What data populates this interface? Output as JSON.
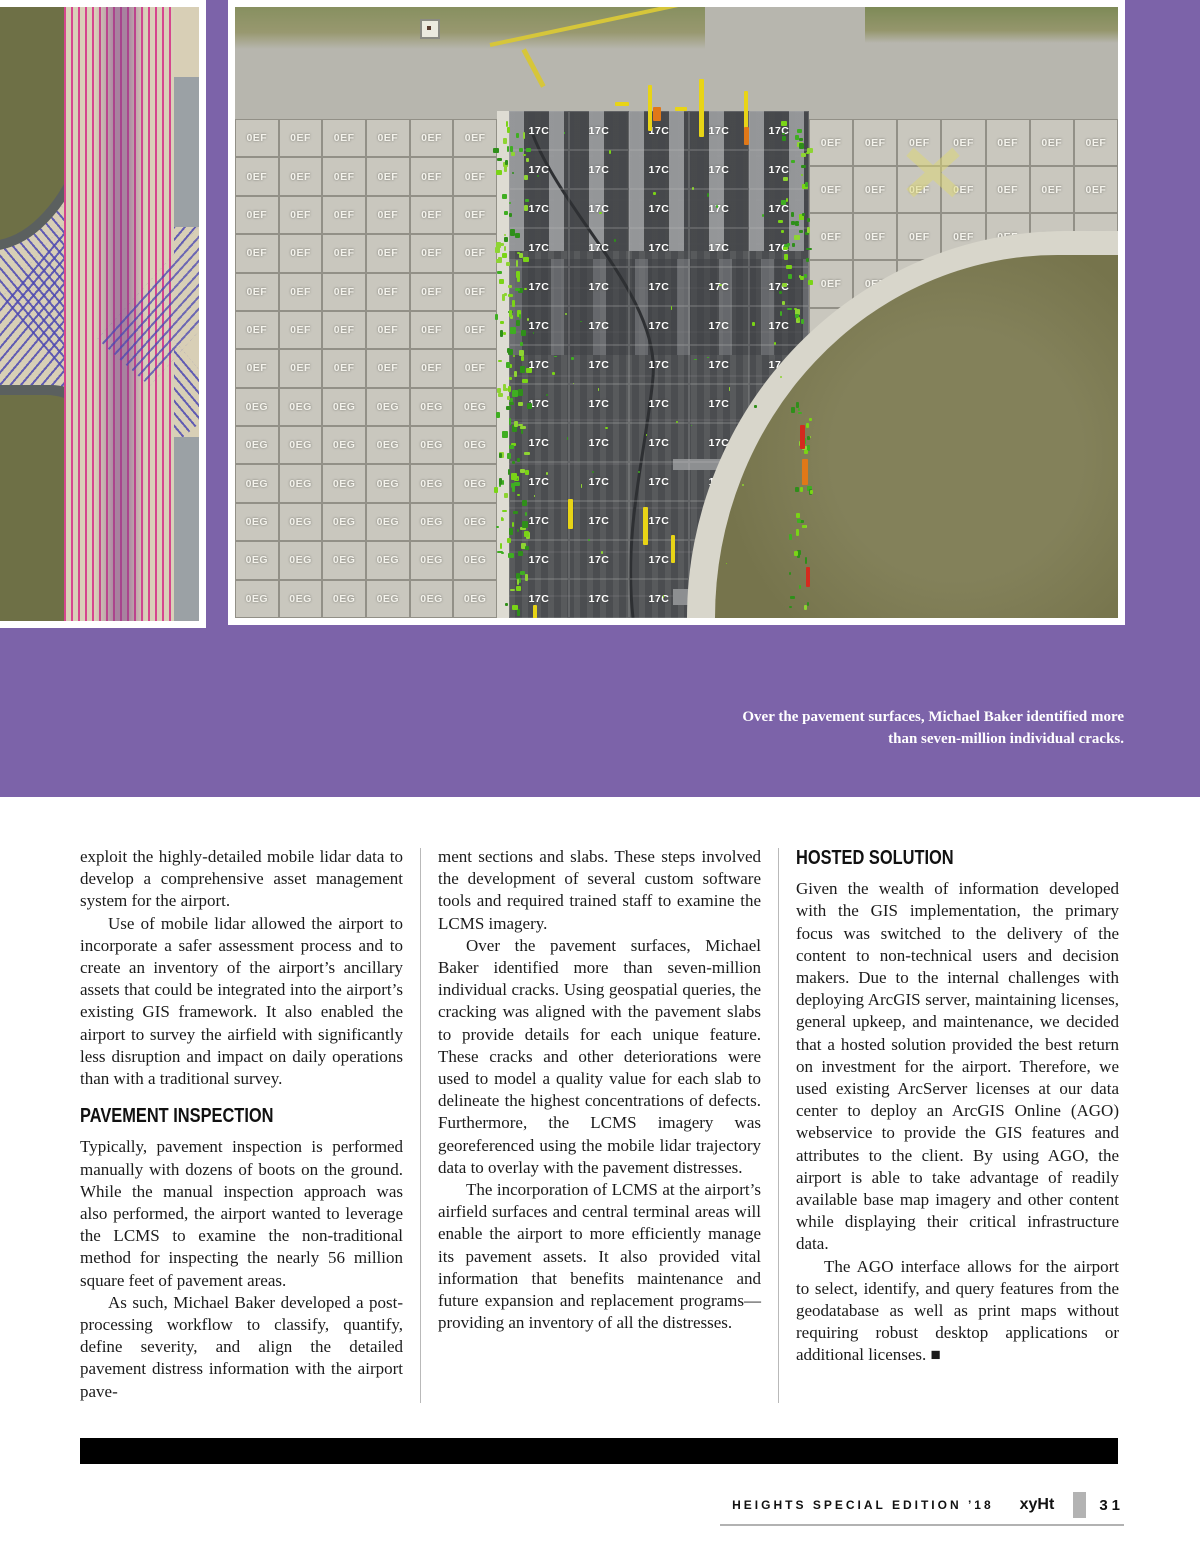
{
  "caption": "Over the pavement surfaces, Michael Baker identified more than seven-million individual cracks.",
  "article": {
    "columns": [
      {
        "blocks": [
          {
            "type": "p",
            "text": "exploit the highly-detailed mobile lidar data to develop a comprehensive asset management system for the airport."
          },
          {
            "type": "p",
            "indent": true,
            "text": "Use of mobile lidar allowed the airport to incorporate a safer assessment process and to create an inventory of the airport’s ancillary assets that could be integrated into the airport’s existing GIS framework. It also enabled the airport to survey the airfield with significantly less disruption and impact on daily operations than with a traditional survey."
          },
          {
            "type": "h",
            "text": "PAVEMENT INSPECTION"
          },
          {
            "type": "p",
            "text": "Typically, pavement inspection is performed manually with dozens of boots on the ground. While the manual inspection approach was also performed, the airport wanted to leverage the LCMS to examine the non-traditional method for inspecting the nearly 56 million square feet of pavement areas."
          },
          {
            "type": "p",
            "indent": true,
            "text": "As such, Michael Baker developed a post-processing workflow to classify, quantify, define severity, and align the detailed pavement distress information with the airport pave-"
          }
        ]
      },
      {
        "blocks": [
          {
            "type": "p",
            "text": "ment sections and slabs. These steps involved the development of several custom software tools and required trained staff to examine the LCMS imagery."
          },
          {
            "type": "p",
            "indent": true,
            "text": "Over the pavement surfaces, Michael Baker identified more than seven-million individual cracks. Using geospatial queries, the cracking was aligned with the pavement slabs to provide details for each unique feature. These cracks and other deteriorations were used to model a quality value for each slab to delineate the highest concentrations of defects. Furthermore, the LCMS imagery was georeferenced using the mobile lidar trajectory data to overlay with the pavement distresses."
          },
          {
            "type": "p",
            "indent": true,
            "text": "The incorporation of LCMS at the airport’s airfield surfaces and central terminal areas will enable the airport to more efficiently manage its pavement assets. It also provided vital information that benefits maintenance and future expansion and replacement programs—providing an inventory of all the distresses."
          }
        ]
      },
      {
        "blocks": [
          {
            "type": "h",
            "text": "HOSTED SOLUTION"
          },
          {
            "type": "p",
            "text": "Given the wealth of information developed with the GIS implementation, the primary focus was switched to the delivery of the content to non-technical users and decision makers. Due to the internal challenges with deploying ArcGIS server, maintaining licenses, general upkeep, and maintenance, we decided that a hosted solution provided the best return on investment for the airport. Therefore, we used existing ArcServer licenses at our data center to deploy an ArcGIS Online (AGO) webservice to provide the GIS features and attributes to the client. By using AGO, the airport is able to take advantage of readily available base map imagery and other content while displaying their critical infrastructure data."
          },
          {
            "type": "p",
            "indent": true,
            "text": "The AGO interface allows for the airport to select, identify, and query features from the geodatabase as well as print maps without requiring robust desktop applications or additional licenses. ■"
          }
        ]
      }
    ]
  },
  "photo_right": {
    "zones": [
      {
        "name": "apron-left",
        "cols": 6,
        "rows": 13,
        "row_labels": [
          "0EF",
          "0EF",
          "0EF",
          "0EF",
          "0EF",
          "0EF",
          "0EF",
          "0EG",
          "0EG",
          "0EG",
          "0EG",
          "0EG",
          "0EG"
        ]
      },
      {
        "name": "runway-center",
        "cols": 5,
        "rows": 13,
        "label": "17C",
        "dark": true
      },
      {
        "name": "apron-right",
        "cols": 7,
        "rows": 7,
        "label": "0EF"
      },
      {
        "name": "apron-right-taper",
        "cols": 3,
        "rows": 2,
        "label": "0EF"
      }
    ],
    "mark_colors": {
      "crack_green": "#3fae22",
      "crack_green_bright": "#7ad416",
      "crack_yellow": "#e8d416",
      "crack_orange": "#e07818",
      "crack_red": "#d42a1e"
    }
  },
  "colors": {
    "hero_purple": "#7c63a9",
    "pink_trajectory": "#d63e8c",
    "blue_trajectory": "#4c48b2"
  },
  "footer": {
    "edition": "H E I G H T S   S P E C I A L   E D I T I O N   ’ 1 8",
    "edition_plain": "HEIGHTS SPECIAL EDITION ’18",
    "logo": "xyHt",
    "page_number": "31"
  }
}
